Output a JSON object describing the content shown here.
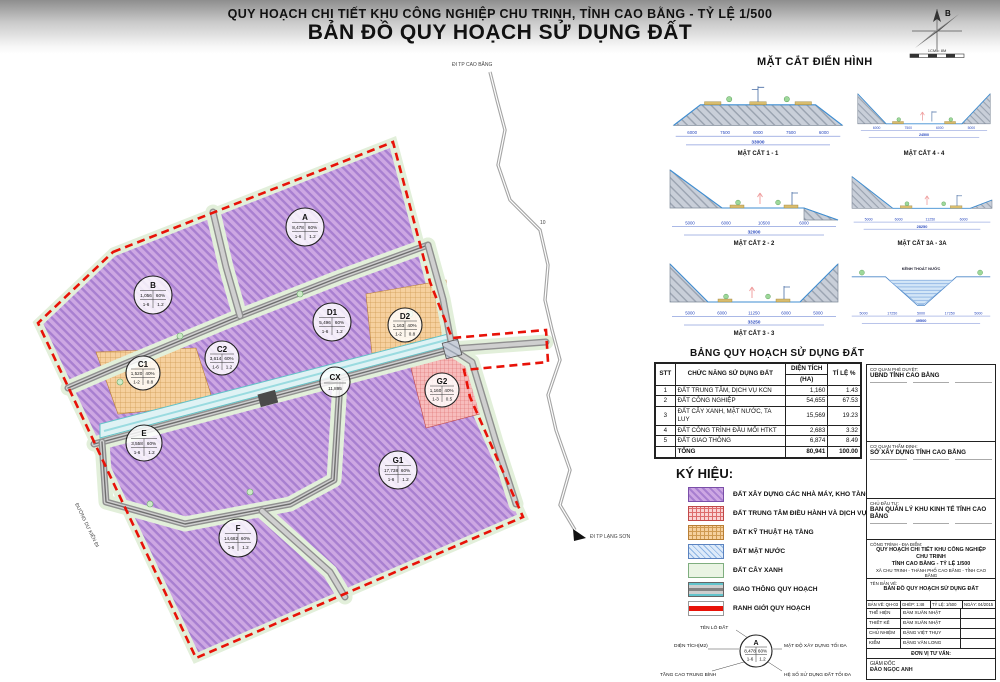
{
  "header": {
    "line1": "QUY HOẠCH CHI TIẾT KHU CÔNG NGHIỆP CHU TRINH, TỈNH CAO BẰNG - TỶ LỆ 1/500",
    "line2": "BẢN ĐỒ QUY HOẠCH SỬ DỤNG ĐẤT"
  },
  "compass": {
    "north": "B",
    "scale": "1CM = 8M"
  },
  "cross_sections": {
    "heading": "MẶT CẮT ĐIỂN HÌNH",
    "items": [
      {
        "caption": "MẶT CẮT 1 - 1",
        "dims": [
          "6000",
          "7500",
          "6000",
          "7500",
          "6000"
        ],
        "total": "33000"
      },
      {
        "caption": "MẶT CẮT 4 - 4",
        "dims": [
          "6000",
          "7500",
          "6000",
          "5000"
        ],
        "total": "24500"
      },
      {
        "caption": "MẶT CẮT 2 - 2",
        "dims": [
          "5000",
          "6000",
          "10500",
          "6000"
        ],
        "total": "32000"
      },
      {
        "caption": "MẶT CẮT 3A - 3A",
        "dims": [
          "5000",
          "6000",
          "11250",
          "6000"
        ],
        "total": "28250"
      },
      {
        "caption": "MẶT CẮT 3 - 3",
        "dims": [
          "5000",
          "6000",
          "11250",
          "6000",
          "5000"
        ],
        "total": "33250"
      },
      {
        "caption": "KÊNH THOÁT NƯỚC",
        "dims": [
          "5000",
          "17250",
          "5000",
          "17250",
          "5000"
        ],
        "total": "49500"
      }
    ]
  },
  "land_use_table": {
    "title": "BẢNG QUY HOẠCH SỬ DỤNG ĐẤT",
    "headers": {
      "stt": "STT",
      "function": "CHỨC NĂNG SỬ DỤNG ĐẤT",
      "area1": "DIỆN TÍCH",
      "area2": "(HA)",
      "ratio": "TỈ LỆ %"
    },
    "rows": [
      {
        "stt": "1",
        "function": "ĐẤT TRUNG TÂM, DỊCH VỤ KCN",
        "area": "1,160",
        "ratio": "1.43"
      },
      {
        "stt": "2",
        "function": "ĐẤT CÔNG NGHIỆP",
        "area": "54,655",
        "ratio": "67.53"
      },
      {
        "stt": "3",
        "function": "ĐẤT CÂY XANH, MẶT NƯỚC, TA LUY",
        "area": "15,569",
        "ratio": "19.23"
      },
      {
        "stt": "4",
        "function": "ĐẤT CÔNG TRÌNH ĐẦU MỐI HTKT",
        "area": "2,683",
        "ratio": "3.32"
      },
      {
        "stt": "5",
        "function": "ĐẤT GIAO THÔNG",
        "area": "6,874",
        "ratio": "8.49"
      },
      {
        "stt": "",
        "function": "TỔNG",
        "area": "80,941",
        "ratio": "100.00"
      }
    ]
  },
  "legend": {
    "heading": "KÝ HIỆU:",
    "items": [
      {
        "label": "ĐẤT XÂY DỰNG CÁC NHÀ MÁY, KHO TÀNG",
        "pattern": "purple-hatch-swatch"
      },
      {
        "label": "ĐẤT TRUNG TÂM ĐIỀU HÀNH VÀ DỊCH VỤ KHU CÔNG NGHIỆP",
        "pattern": "red-grid-swatch"
      },
      {
        "label": "ĐẤT KỸ THUẬT HẠ TẦNG",
        "pattern": "orange-grid-swatch"
      },
      {
        "label": "ĐẤT MẶT NƯỚC",
        "pattern": "blue-hatch-swatch"
      },
      {
        "label": "ĐẤT CÂY XANH",
        "pattern": "green-swatch"
      },
      {
        "label": "GIAO THÔNG QUY HOẠCH",
        "pattern": "road-swatch"
      },
      {
        "label": "RANH GIỚI QUY HOẠCH",
        "pattern": "red-line-swatch"
      }
    ]
  },
  "title_block": {
    "approve_label": "CƠ QUAN PHÊ DUYỆT:",
    "approve_name": "UBND TỈNH CAO BẰNG",
    "review_label": "CƠ QUAN THẨM ĐỊNH:",
    "review_name": "SỞ XÂY DỰNG TỈNH CAO BẰNG",
    "investor_label": "CHỦ ĐẦU TƯ:",
    "investor_name": "BAN QUẢN LÝ KHU KINH TẾ TỈNH CAO BẰNG",
    "project_label": "CÔNG TRÌNH - ĐỊA ĐIỂM:",
    "project_line1": "QUY HOẠCH CHI TIẾT KHU CÔNG NGHIỆP CHU TRINH",
    "project_line2": "TỈNH CAO BẰNG - TỶ LỆ 1/500",
    "project_line3": "XÃ CHU TRINH - THÀNH PHỐ CAO BẰNG - TỈNH CAO BẰNG",
    "drawing_label": "TÊN BẢN VẼ:",
    "drawing_name": "BẢN ĐỒ QUY HOẠCH SỬ DỤNG ĐẤT",
    "sheet": "BẢN VẼ: QH-03",
    "merge": "GHÉP: 1:48",
    "scale": "TỶ LỆ: 1/500",
    "date": "NGÀY: 04/2015",
    "rows": [
      {
        "label": "THỂ HIỆN",
        "value": "ĐÀM XUÂN NHẬT"
      },
      {
        "label": "THIẾT KẾ",
        "value": "ĐÀM XUÂN NHẬT"
      },
      {
        "label": "CHỦ NHIỆM",
        "value": "ĐẶNG VIỆT THỤY"
      },
      {
        "label": "KIỂM",
        "value": "ĐẶNG VĂN LONG"
      }
    ],
    "consultant_label": "ĐƠN VỊ TƯ VẤN:",
    "director_label": "GIÁM ĐỐC",
    "director_name": "ĐÀO NGỌC ANH"
  },
  "annotation": {
    "name_label": "TÊN LÔ ĐẤT",
    "area_label": "DIỆN TÍCH(M2)",
    "floors_label": "TẦNG CAO TRUNG BÌNH",
    "density_label": "MẬT ĐỘ XÂY DỰNG TỐI ĐA",
    "far_label": "HỆ SỐ SỬ DỤNG ĐẤT TỐI ĐA",
    "example": {
      "name": "A",
      "area": "8,478",
      "density": "60%",
      "floors": "1-6",
      "far": "1.2"
    }
  },
  "map": {
    "zones": [
      {
        "name": "A",
        "area": "8,478",
        "density": "60%",
        "floors": "1-6",
        "far": "1.2"
      },
      {
        "name": "B",
        "area": "1,056",
        "density": "60%",
        "floors": "1-6",
        "far": "1.2"
      },
      {
        "name": "C1",
        "area": "1,520",
        "density": "40%",
        "floors": "1-2",
        "far": "0.8"
      },
      {
        "name": "C2",
        "area": "3,614",
        "density": "60%",
        "floors": "1-6",
        "far": "1.2"
      },
      {
        "name": "D1",
        "area": "5,496",
        "density": "60%",
        "floors": "1-6",
        "far": "1.2"
      },
      {
        "name": "D2",
        "area": "1,163",
        "density": "40%",
        "floors": "1-2",
        "far": "0.8"
      },
      {
        "name": "CX",
        "area": "11,895",
        "density": "",
        "floors": "",
        "far": ""
      },
      {
        "name": "G2",
        "area": "1,160",
        "density": "40%",
        "floors": "1-3",
        "far": "0.5"
      },
      {
        "name": "E",
        "area": "3,558",
        "density": "60%",
        "floors": "1-6",
        "far": "1.2"
      },
      {
        "name": "G1",
        "area": "17,738",
        "density": "60%",
        "floors": "1-6",
        "far": "1.2"
      },
      {
        "name": "F",
        "area": "14,682",
        "density": "60%",
        "floors": "1-6",
        "far": "1.2"
      }
    ],
    "labels": {
      "road_north": "ĐI TP CAO BẰNG",
      "road_south": "ĐI TP LẠNG SƠN",
      "planned_road": "ĐƯỜNG DỰ KIẾN ĐI",
      "road_number": "10"
    }
  },
  "colors": {
    "boundary_red": "#e81208",
    "industrial_purple": "#cda7e3",
    "infrastructure_orange": "#f6d09e",
    "center_service_red": "#f7bcbc",
    "water_blue": "#d3e6f7",
    "green_land": "#e9f4e3",
    "canal_cyan": "#dff2f4",
    "road_gray": "#bdbdbd"
  }
}
